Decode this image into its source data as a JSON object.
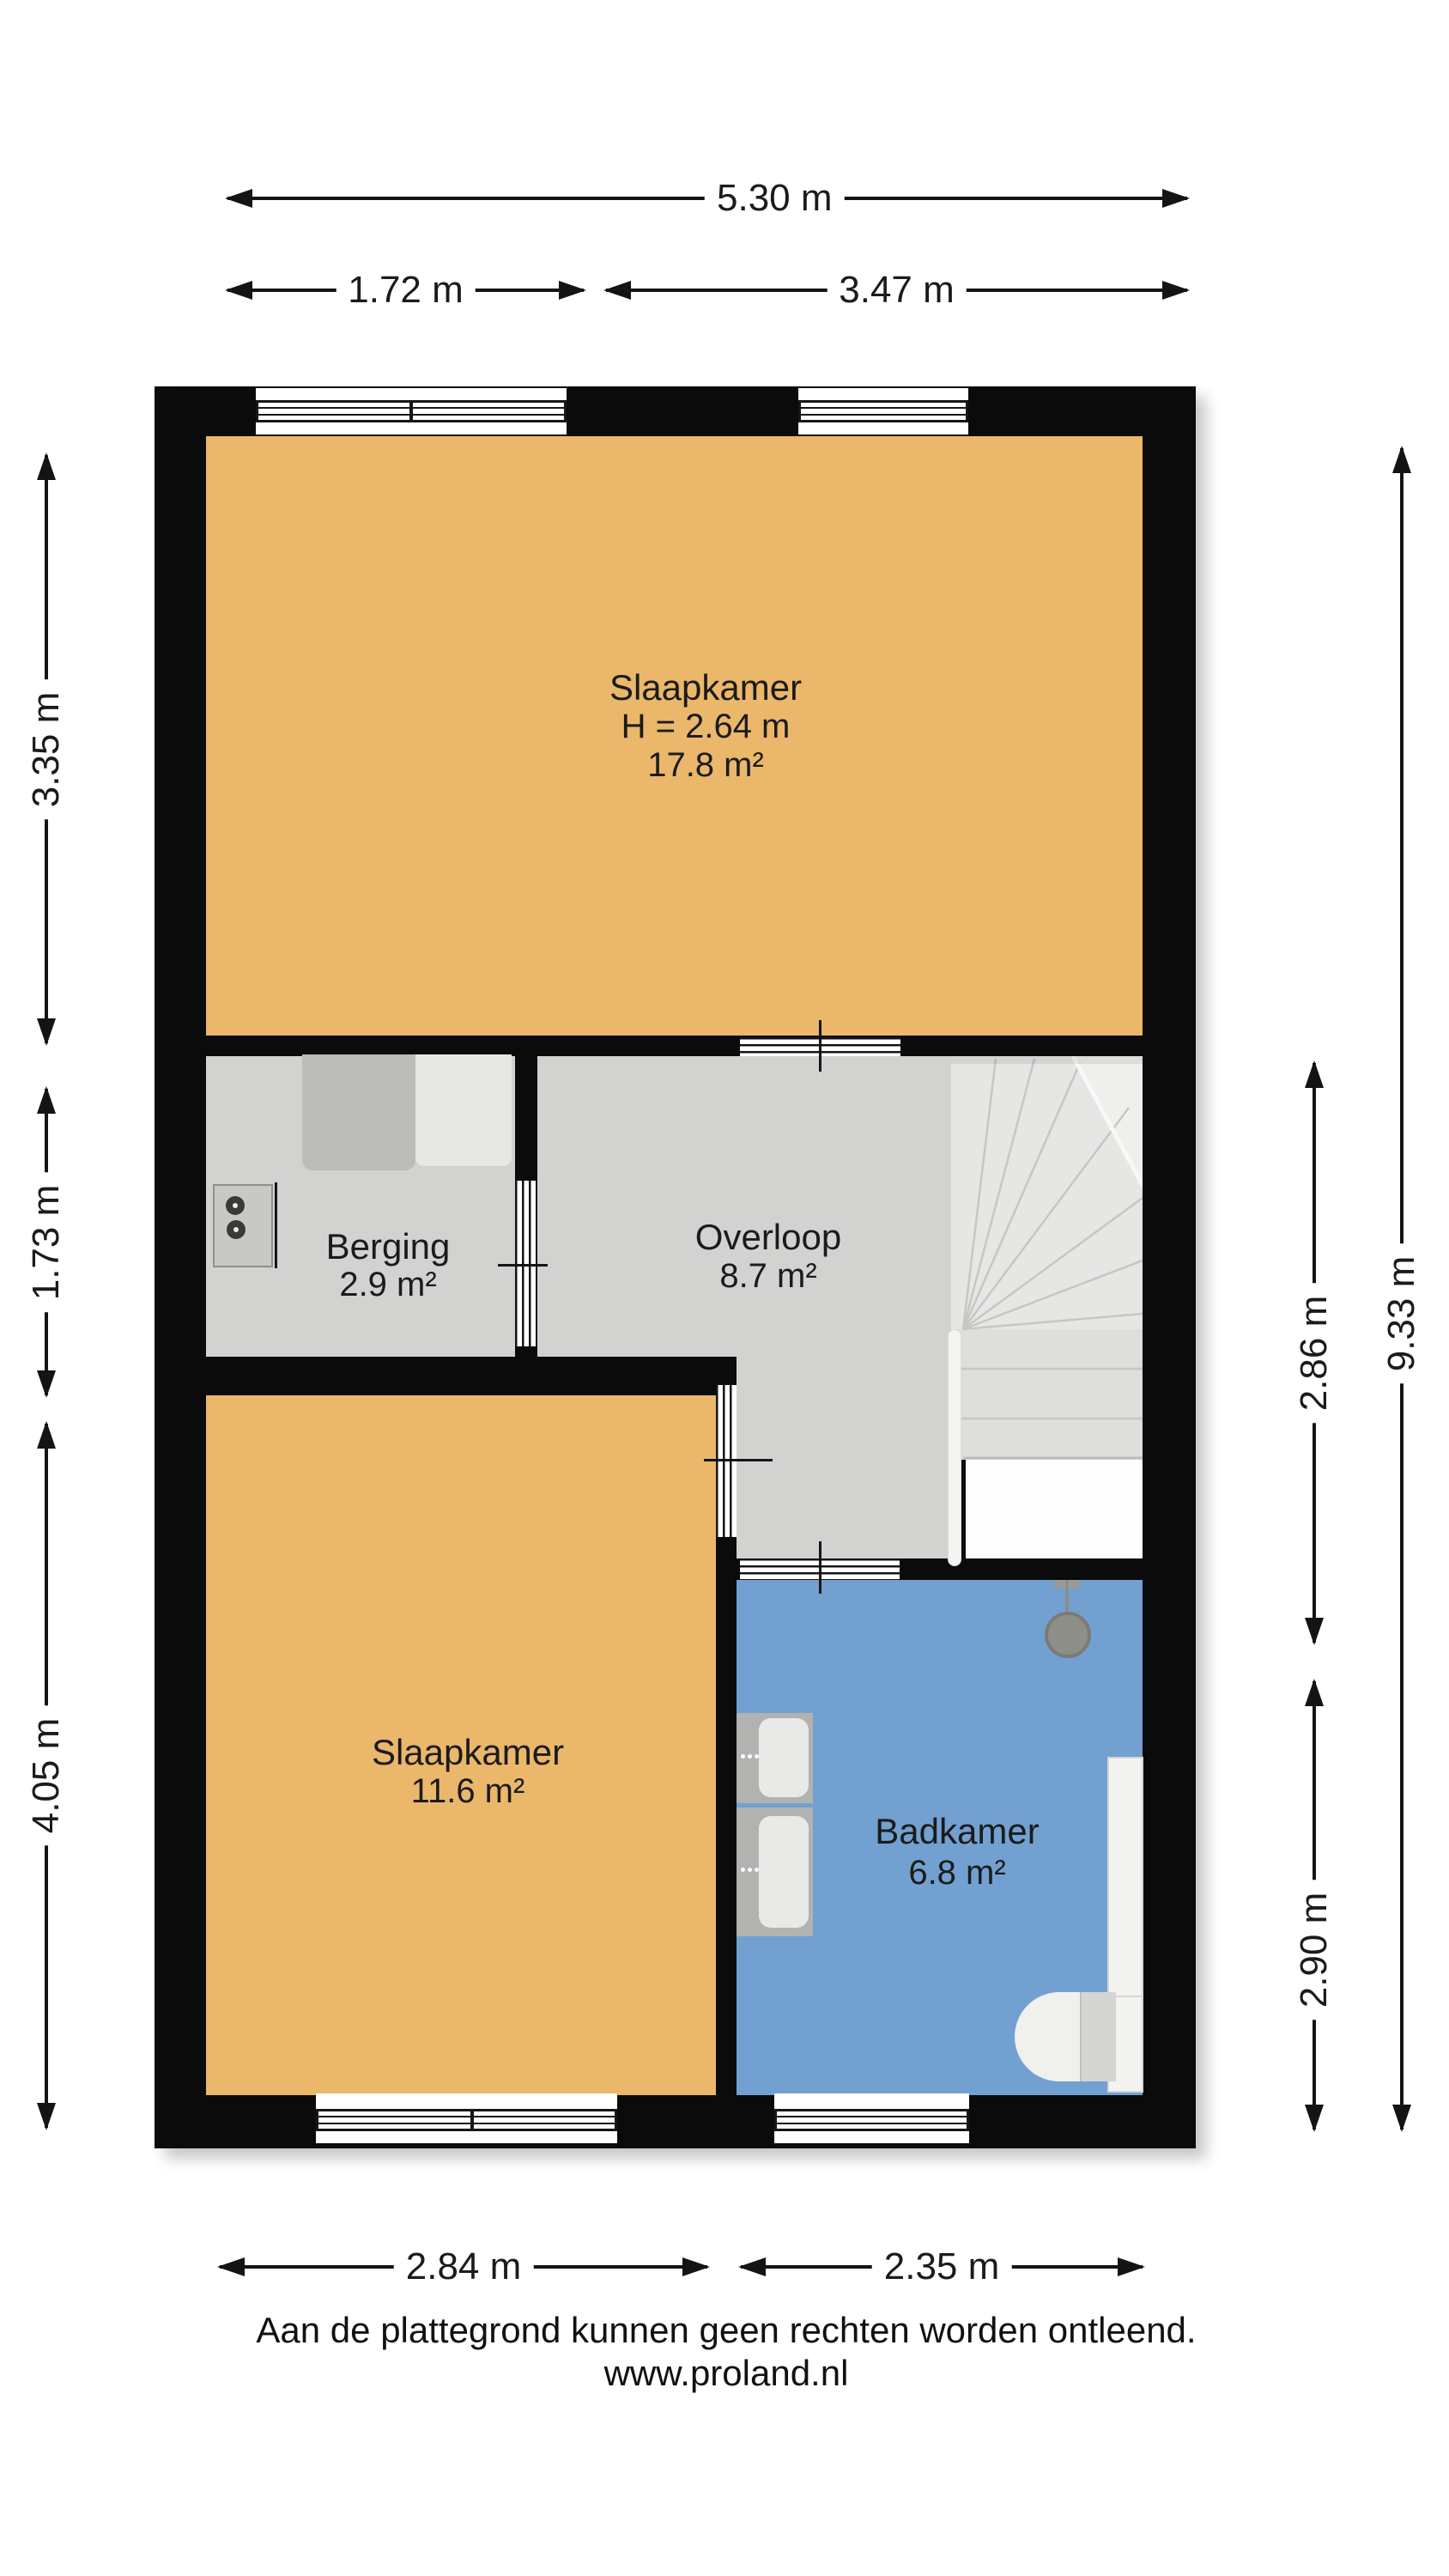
{
  "plan": {
    "type": "floor-plan",
    "rooms": {
      "slaapkamer_1": {
        "name": "Slaapkamer",
        "ceiling_height": "H = 2.64 m",
        "area": "17.8 m²",
        "fill": "#EAB76B"
      },
      "berging": {
        "name": "Berging",
        "area": "2.9 m²",
        "fill": "#D2D2D1"
      },
      "overloop": {
        "name": "Overloop",
        "area": "8.7 m²",
        "fill": "#D2D2D1"
      },
      "slaapkamer_2": {
        "name": "Slaapkamer",
        "area": "11.6 m²",
        "fill": "#EAB76B"
      },
      "badkamer": {
        "name": "Badkamer",
        "area": "6.8 m²",
        "fill": "#72A0D0"
      }
    },
    "colors": {
      "wall": "#0B0B0B",
      "bedroom": "#EAB76B",
      "hallway": "#D2D2D1",
      "bathroom": "#72A0D0",
      "stairs": "#E6E6E5"
    },
    "icons": {
      "stairs": "stairs-icon",
      "washing_machine": "washing-machine-icon",
      "wardrobe": "wardrobe-icon",
      "sink": "sink-icon",
      "shower_head": "shower-head-icon",
      "shower_tray": "shower-tray-icon",
      "toilet": "toilet-icon",
      "window": "window-icon",
      "door": "door-icon"
    }
  },
  "dimensions": {
    "top_total": "5.30 m",
    "top_left_segment": "1.72 m",
    "top_right_segment": "3.47 m",
    "left_top": "3.35 m",
    "left_middle": "1.73 m",
    "left_bottom": "4.05 m",
    "right_overloop": "2.86 m",
    "right_badkamer": "2.90 m",
    "right_total": "9.33 m",
    "bottom_left_segment": "2.84 m",
    "bottom_right_segment": "2.35 m"
  },
  "footer": {
    "disclaimer": "Aan de plattegrond kunnen geen rechten worden ontleend.",
    "website": "www.proland.nl"
  }
}
